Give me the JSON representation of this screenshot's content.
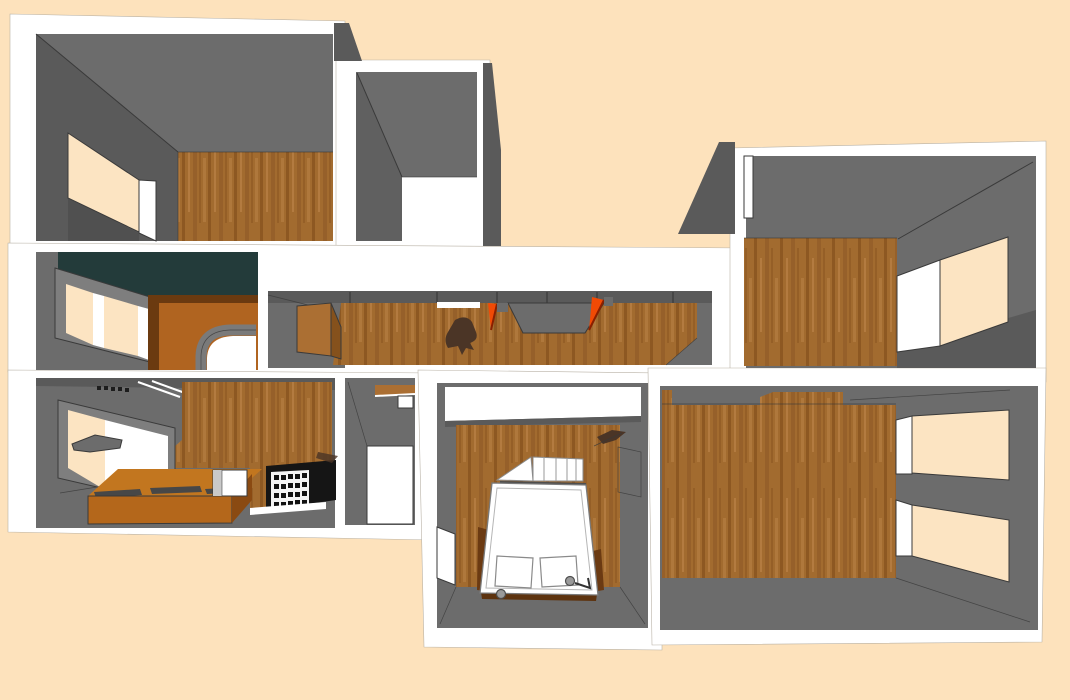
{
  "description": "3D cutaway overhead rendering of an apartment floor plan with gray walls, wooden floors, peach background, windows, a bed, kitchen counter and shelving",
  "colors": {
    "background": "#fde2bc",
    "slab_white": "#ffffff",
    "wall_gray": "#6c6c6c",
    "wall_gray_dark": "#5a5a5a",
    "wall_gray_deep": "#4a4a4a",
    "edge_line": "#3a3a3a",
    "wood_base": "#a26b2f",
    "wood_streak_dark": "#8a5520",
    "wood_streak_mid": "#96602a",
    "wood_streak_light": "#b57d42",
    "wood_panel": "#ab6f33",
    "wood_panel_dark": "#85511c",
    "ceiling_teal": "#233b3a",
    "arch_panel_orange": "#b06420",
    "arch_panel_dark": "#6b3a10",
    "accent_orange": "#f14a05",
    "accent_dark_red": "#8a2000",
    "counter_top": "#c2761f",
    "counter_front": "#b4671b",
    "counter_side_dark": "#8a4a12",
    "cabinet_black": "#151515",
    "window_frame": "#7e7e7e",
    "blob_brown": "#4b3526",
    "pane_peach": "#fce4c2"
  }
}
